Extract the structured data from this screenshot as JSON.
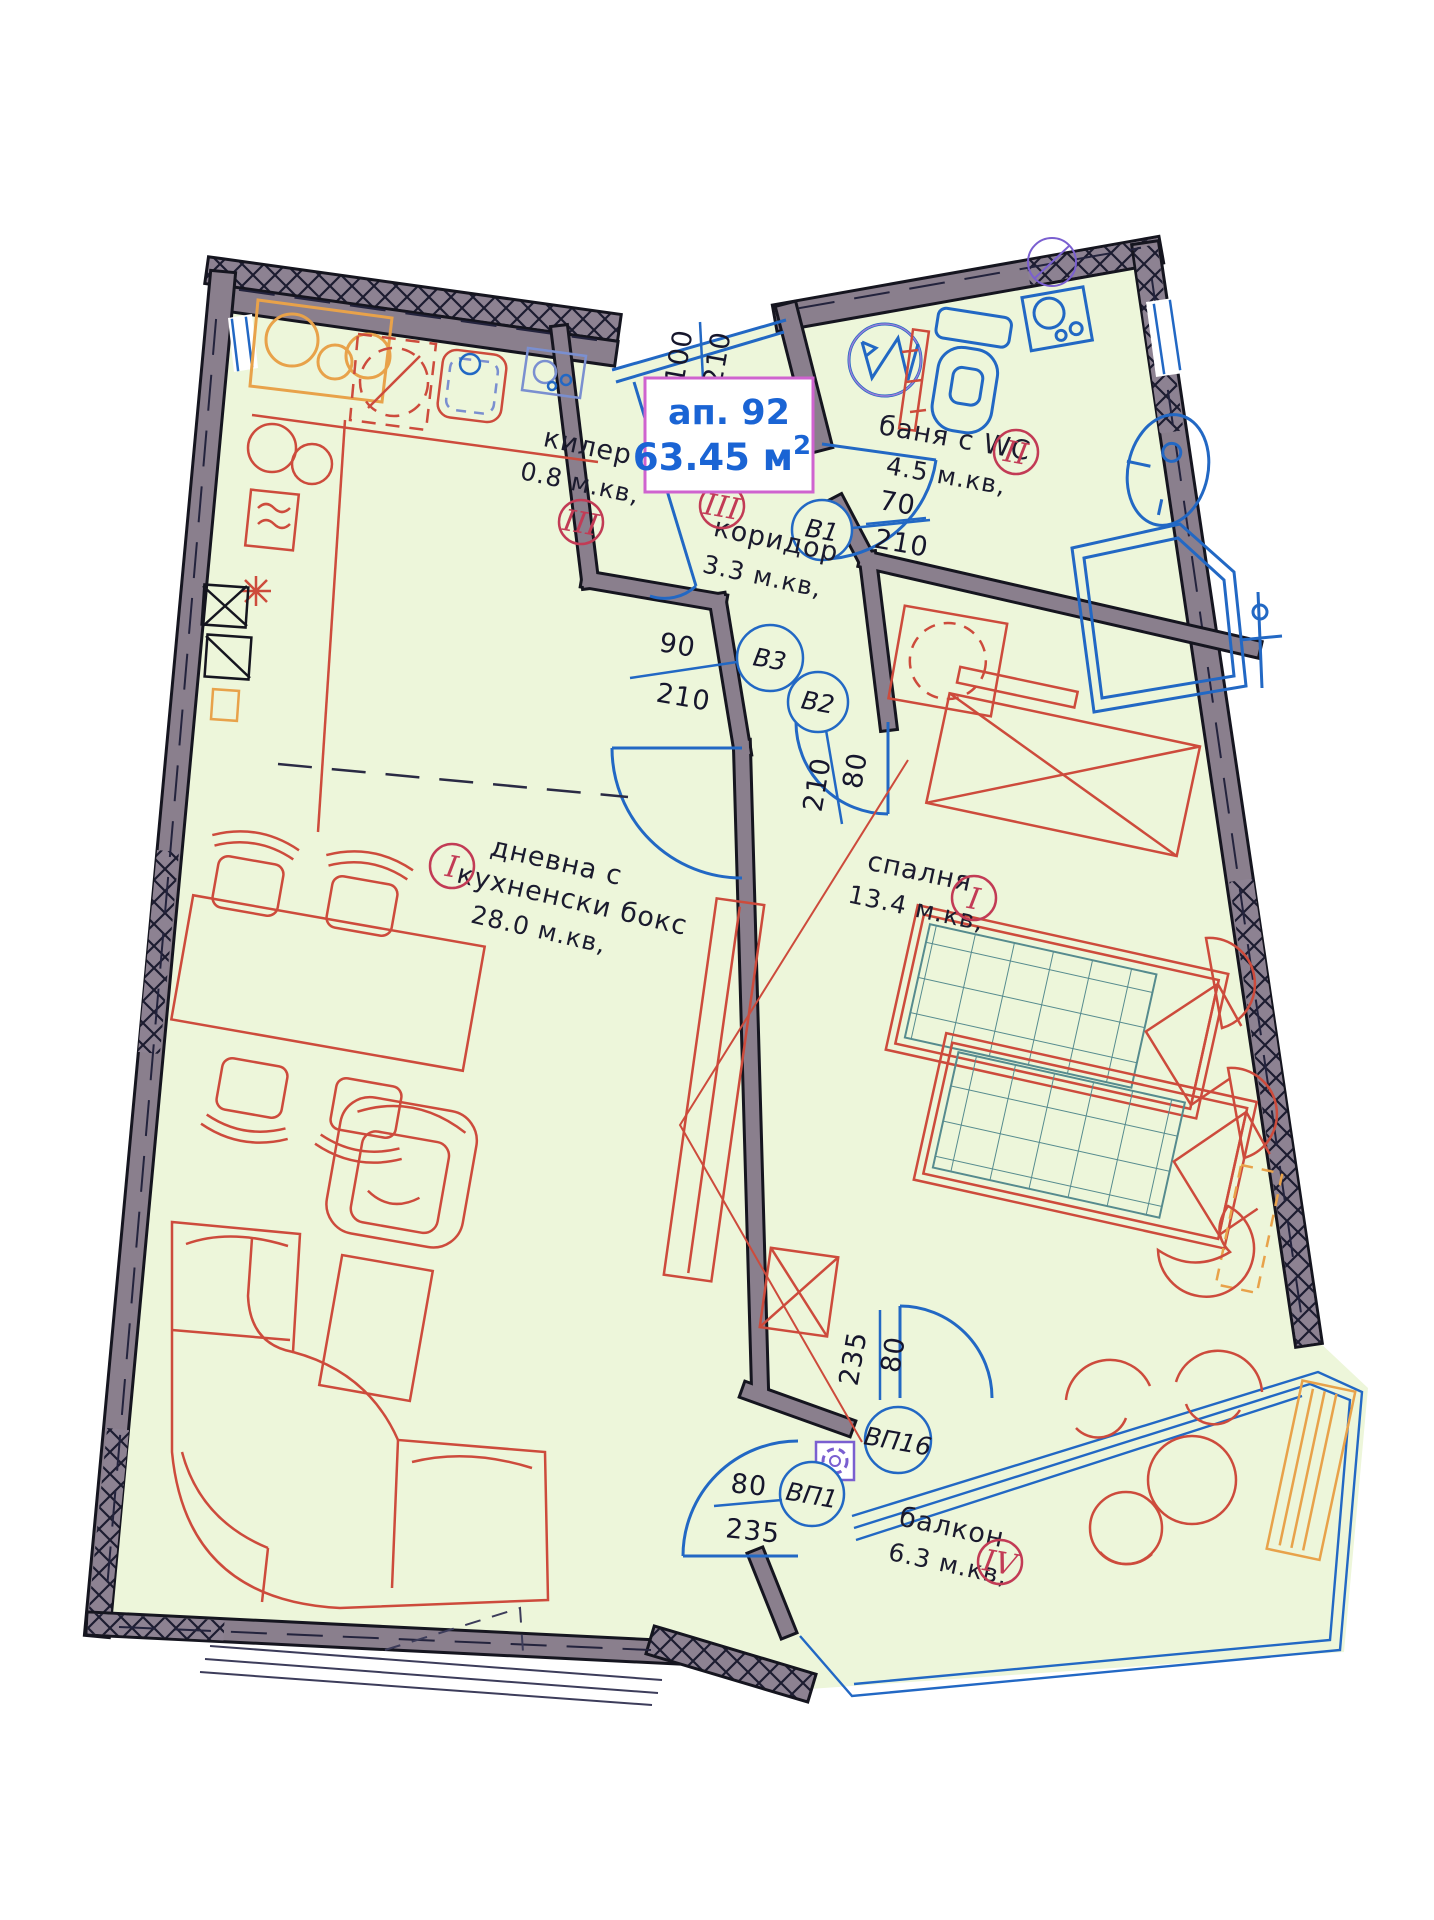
{
  "title_box": {
    "apartment": "ап. 92",
    "area": "63.45 м",
    "area_exp": "2"
  },
  "rooms": {
    "closet": {
      "name": "килер",
      "area": "0.8 м.кв,",
      "numeral": "III"
    },
    "corridor": {
      "name": "коридор",
      "area": "3.3 м.кв,",
      "numeral": "III"
    },
    "bath": {
      "name": "баня с WC",
      "area": "4.5 м.кв,",
      "numeral": "II"
    },
    "living": {
      "name_line1": "дневна с",
      "name_line2": "кухненски бокс",
      "area": "28.0 м.кв,",
      "numeral": "I"
    },
    "bedroom": {
      "name": "спалня",
      "area": "13.4 м.кв,",
      "numeral": "I"
    },
    "balcony": {
      "name": "балкон",
      "area": "6.3 м.кв,",
      "numeral": "IV"
    }
  },
  "doors": {
    "B1": {
      "label": "В1",
      "width": "70",
      "height": "210"
    },
    "B2": {
      "label": "В2",
      "width": "80",
      "height": "210"
    },
    "B3": {
      "label": "В3",
      "width": "90",
      "height": "210"
    },
    "BP1": {
      "label": "ВП1",
      "width": "80",
      "height": "235"
    },
    "BP16": {
      "label": "ВП16",
      "width": "80",
      "height": "235"
    }
  },
  "window_dim": {
    "width": "100",
    "height": "210"
  },
  "colors": {
    "floor": "#edf6da",
    "wall_fill": "#8a7f8d",
    "wall_edge": "#15151f",
    "plumbing_blue": "#2268c4",
    "furniture_red": "#cd4b3c",
    "numeral_crimson": "#c23b55",
    "title_blue": "#1a64d4",
    "title_border": "#cf63cf",
    "mattress_teal": "#568b8e",
    "accent_orange": "#e8a24a",
    "drain_purple": "#7a5fd0"
  }
}
